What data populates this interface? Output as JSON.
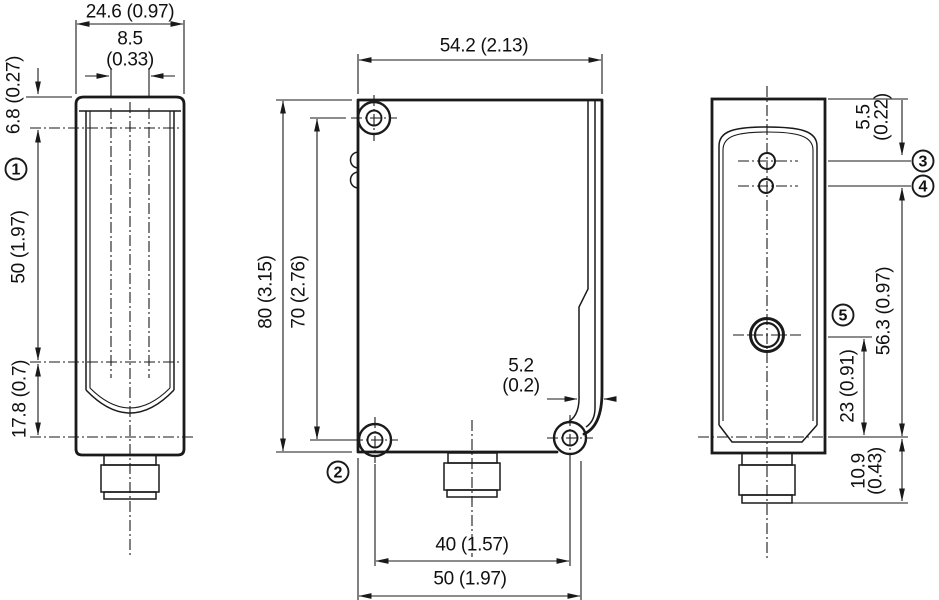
{
  "drawing": {
    "front_view": {
      "width": "24.6 (0.97)",
      "lens_spacing_mm": "8.5",
      "lens_spacing_in": "(0.33)",
      "top_to_axis": "6.8 (0.27)",
      "axis_span": "50 (1.97)",
      "axis_to_bottom": "17.8 (0.7)"
    },
    "side_view": {
      "depth": "54.2 (2.13)",
      "height": "80 (3.15)",
      "hole_spacing_vertical": "70 (2.76)",
      "notch_mm": "5.2",
      "notch_in": "(0.2)",
      "hole_spacing_horizontal": "40 (1.57)",
      "base_width": "50 (1.97)"
    },
    "rear_view": {
      "hole_offset_mm": "5.5",
      "hole_offset_in": "(0.22)",
      "indicator_to_base": "56.3 (0.97)",
      "adjuster_to_base": "23 (0.91)",
      "connector_mm": "10.9",
      "connector_in": "(0.43)"
    },
    "callouts": {
      "c1": "1",
      "c2": "2",
      "c3": "3",
      "c4": "4",
      "c5": "5"
    }
  }
}
